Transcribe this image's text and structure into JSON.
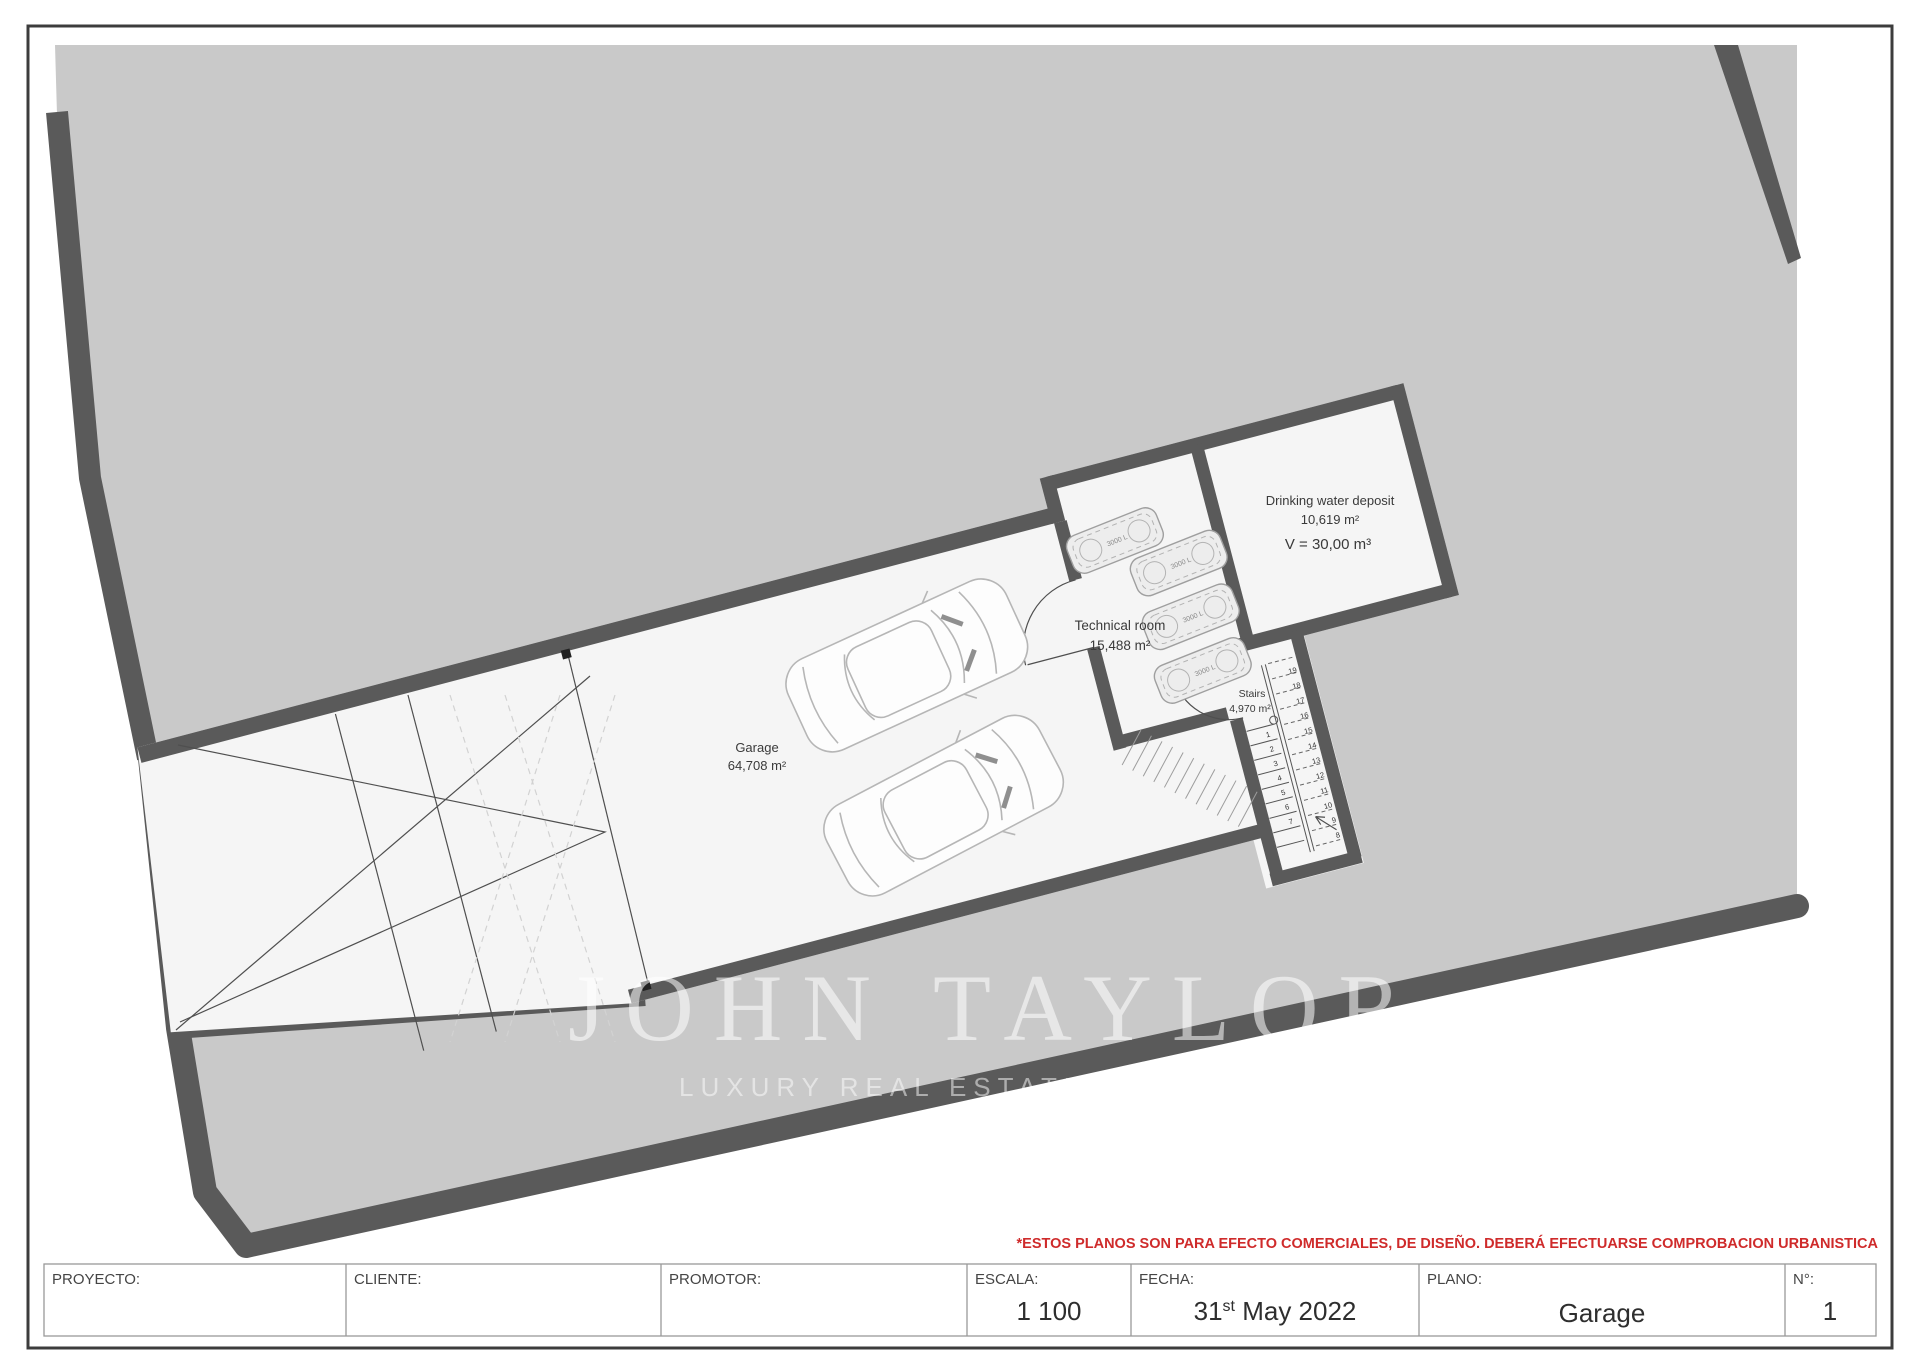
{
  "disclaimer": "*ESTOS PLANOS SON PARA EFECTO COMERCIALES, DE DISEÑO. DEBERÁ EFECTUARSE COMPROBACION URBANISTICA",
  "title_block": {
    "proyecto_label": "PROYECTO:",
    "cliente_label": "CLIENTE:",
    "promotor_label": "PROMOTOR:",
    "escala_label": "ESCALA:",
    "escala_value": "1 100",
    "fecha_label": "FECHA:",
    "fecha_day": "31",
    "fecha_day_suffix": "st",
    "fecha_rest": " May 2022",
    "plano_label": "PLANO:",
    "plano_value": "Garage",
    "numero_label": "N°:",
    "numero_value": "1"
  },
  "watermark": {
    "line1": "JOHN TAYLOR",
    "line2": "LUXURY REAL ESTATE SINCE 1864"
  },
  "rooms": {
    "garage": {
      "name": "Garage",
      "area": "64,708 m²"
    },
    "technical": {
      "name": "Technical room",
      "area": "15,488 m²"
    },
    "deposit": {
      "name": "Drinking water deposit",
      "area": "10,619 m²",
      "volume": "V = 30,00 m³"
    },
    "stairs": {
      "name": "Stairs",
      "area": "4,970 m²"
    }
  },
  "tanks": {
    "label": "3000 L",
    "count": 4
  },
  "stairs_numbers": {
    "lower": [
      "1",
      "2",
      "3",
      "4",
      "5",
      "6",
      "7"
    ],
    "upper": [
      "8",
      "9",
      "10",
      "11",
      "12",
      "13",
      "14",
      "15",
      "16",
      "17",
      "18",
      "19"
    ]
  },
  "colors": {
    "sea": "#c9c9c9",
    "wall": "#5a5a5a",
    "interior": "#f5f5f5",
    "red": "#cf2b2b"
  }
}
